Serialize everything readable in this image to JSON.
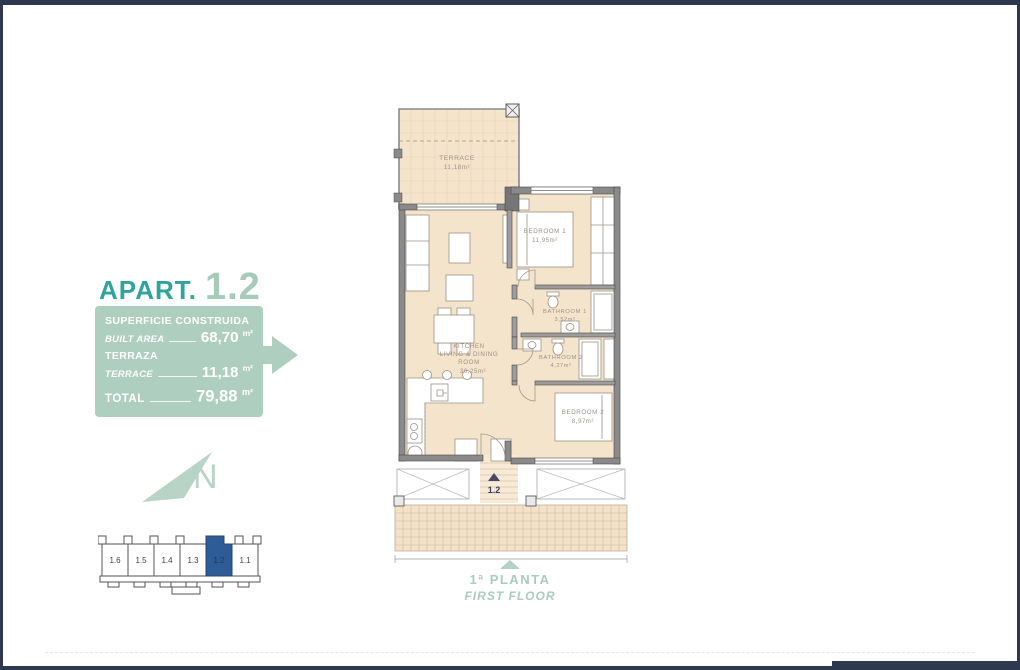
{
  "title": {
    "word": "APART.",
    "number": "1.2"
  },
  "info_box": {
    "built_label_es": "SUPERFICIE CONSTRUIDA",
    "built_label_en": "BUILT AREA",
    "built_value": "68,70",
    "terrace_label_es": "TERRAZA",
    "terrace_label_en": "TERRACE",
    "terrace_value": "11,18",
    "total_label": "TOTAL",
    "total_value": "79,88",
    "unit": "m²"
  },
  "rooms": {
    "terrace": {
      "name": "TERRACE",
      "area": "11,18m²"
    },
    "bedroom1": {
      "name": "BEDROOM  1",
      "area": "11,95m²"
    },
    "bathroom1": {
      "name": "BATHROOM  1",
      "area": "3,52m²"
    },
    "bathroom2": {
      "name": "BATHROOM  2",
      "area": "4,27m²"
    },
    "kitchen": {
      "line1": "KITCHEN",
      "line2": "LIVING  &  DINING",
      "line3": "ROOM",
      "area": "30,25m²"
    },
    "bedroom2": {
      "name": "BEDROOM  2",
      "area": "8,97m²"
    }
  },
  "entry_label": "1.2",
  "compass": {
    "letter": "N"
  },
  "key_plan": {
    "units": [
      "1.6",
      "1.5",
      "1.4",
      "1.3",
      "1.2",
      "1.1"
    ],
    "highlighted": "1.2"
  },
  "floor_caption": {
    "es": "1ª PLANTA",
    "en": "FIRST FLOOR"
  },
  "colors": {
    "navy_frame": "#2e3950",
    "teal_title": "#2ea49d",
    "sage": "#aecfc0",
    "room_fill": "#f5e4cc",
    "wall_gray": "#8a8a8a",
    "keyplan_highlight": "#2d5c97"
  }
}
